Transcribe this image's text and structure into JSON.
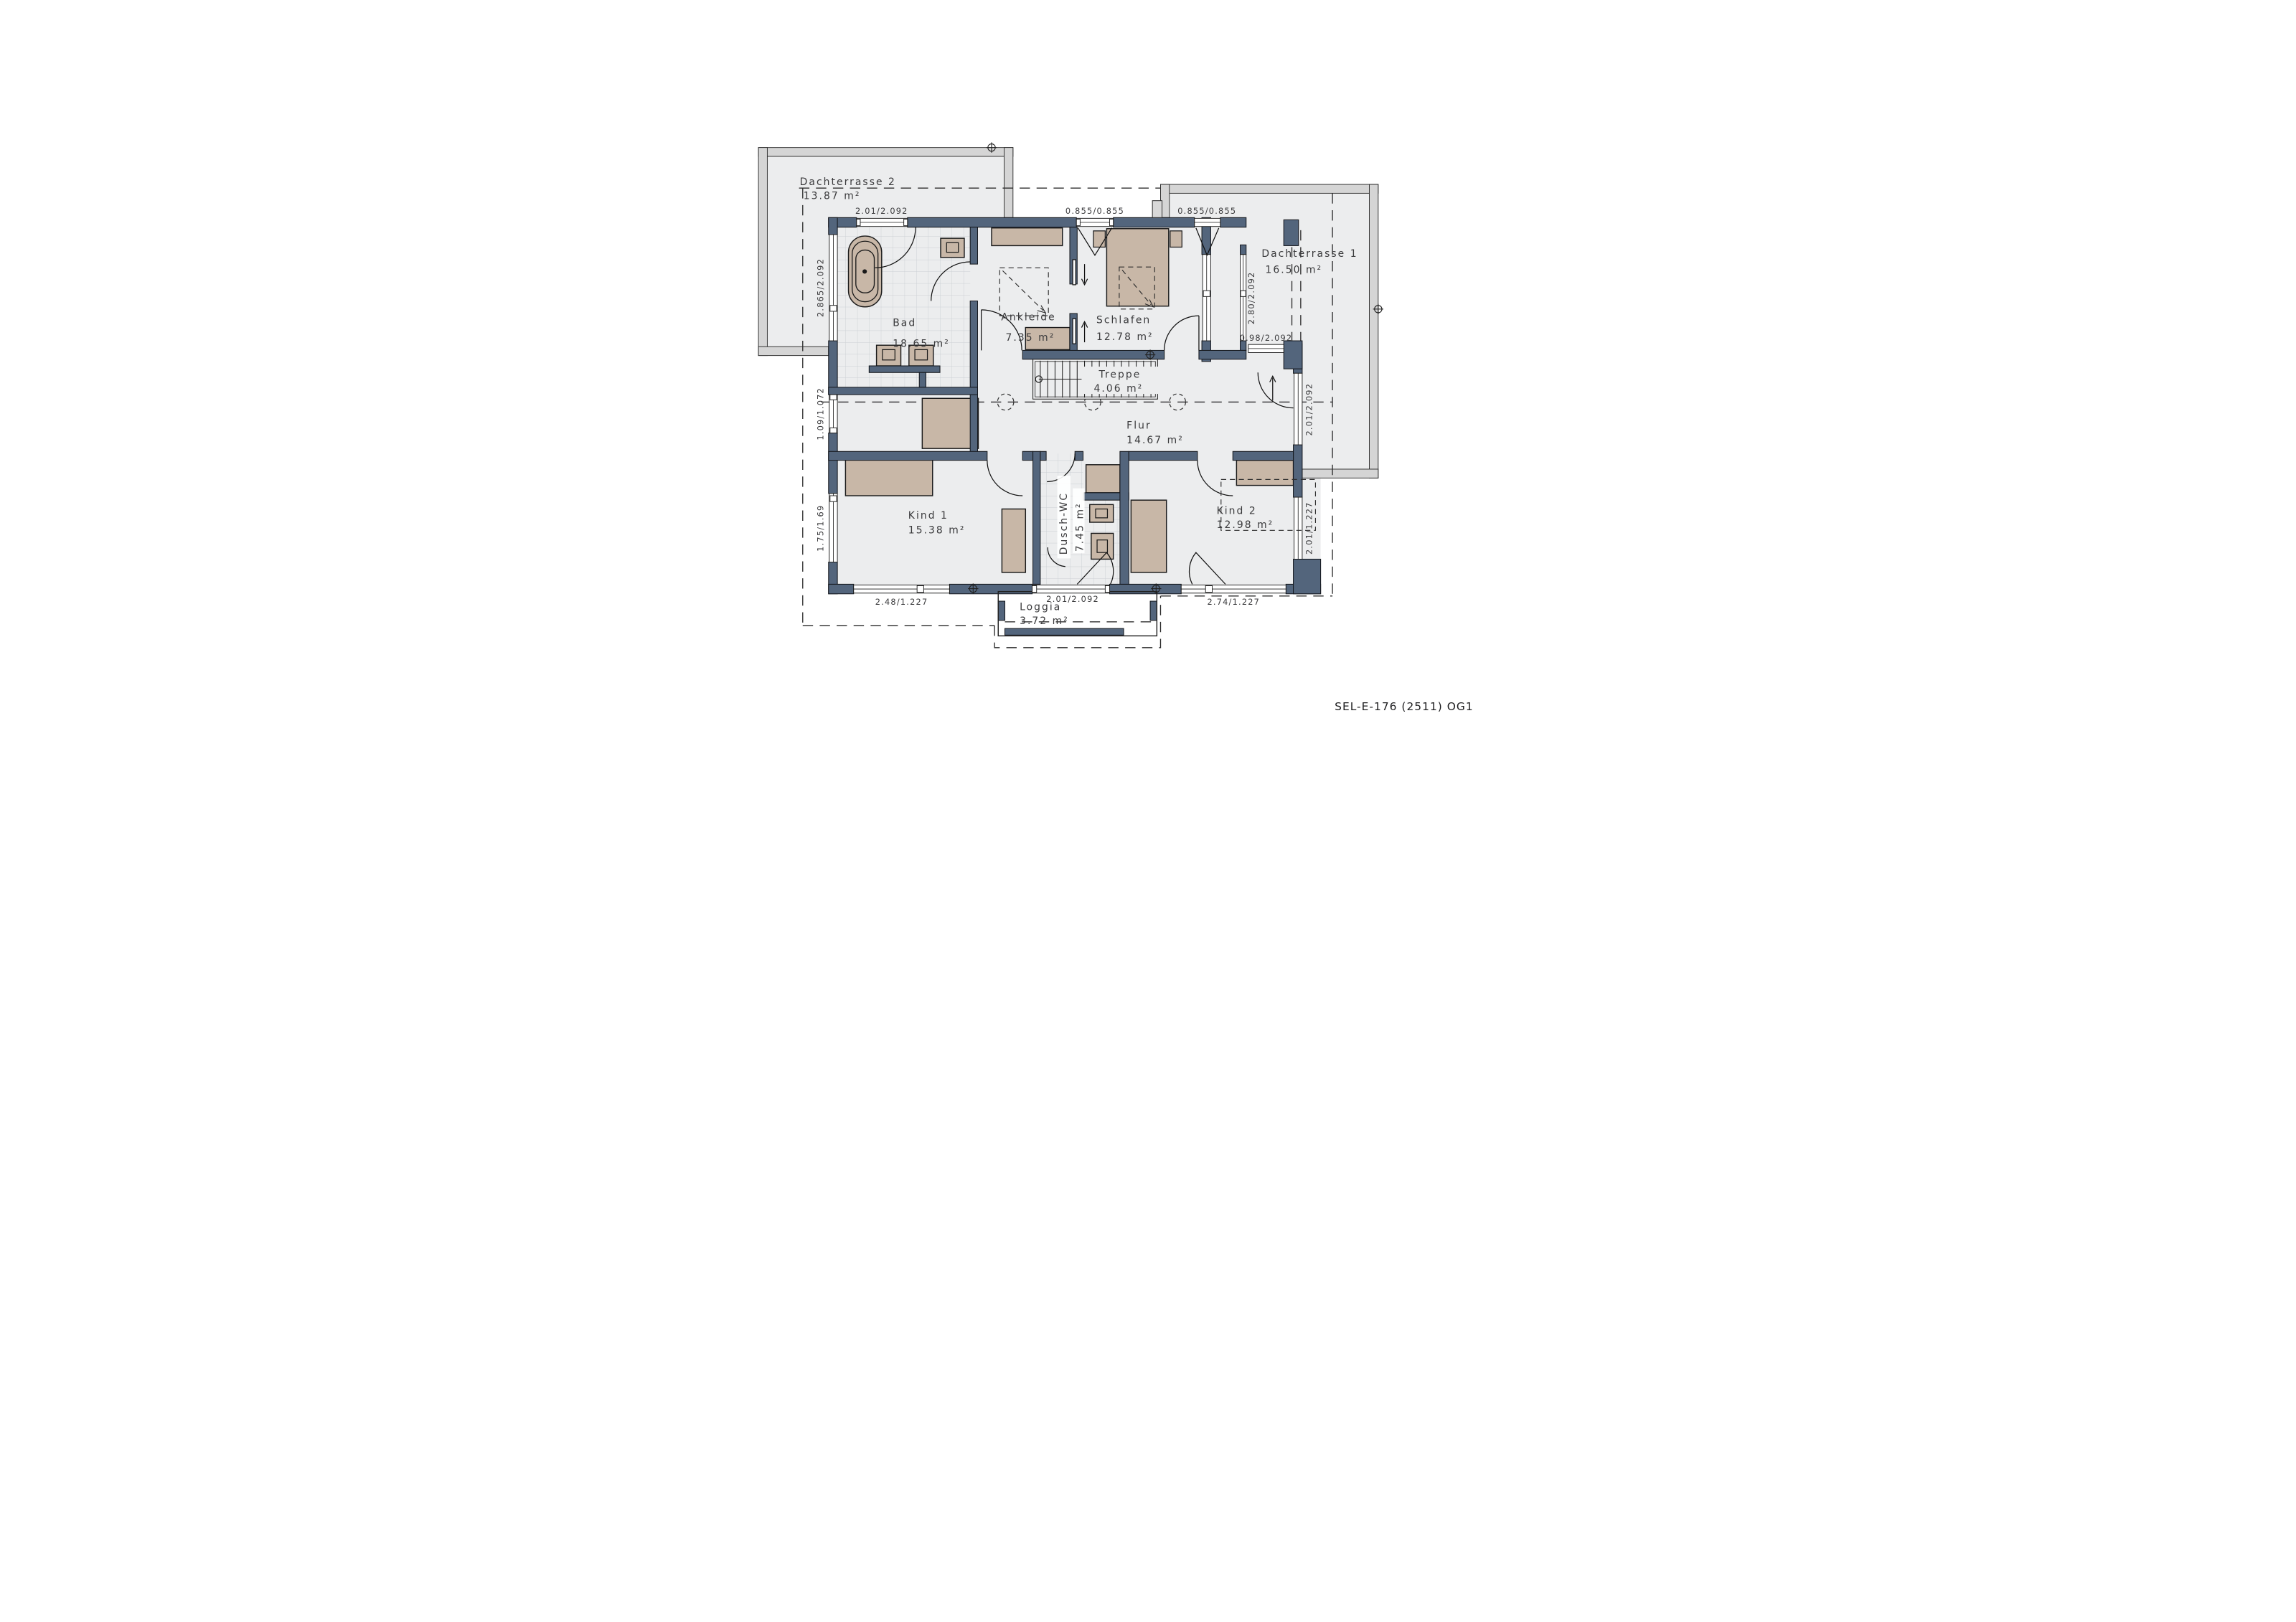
{
  "title": "SEL-E-176 (2511) OG1",
  "colors": {
    "wall": "#53657c",
    "floor": "#ecedee",
    "terrace_band": "#d5d5d5",
    "furniture": "#c8b7a7",
    "background": "#ffffff"
  },
  "rooms": {
    "dachterrasse2": {
      "name": "Dachterrasse 2",
      "area": "13.87 m²"
    },
    "dachterrasse1": {
      "name": "Dachterrasse 1",
      "area": "16.50 m²"
    },
    "bad": {
      "name": "Bad",
      "area": "18.65 m²"
    },
    "ankleide": {
      "name": "Ankleide",
      "area": "7.35 m²"
    },
    "schlafen": {
      "name": "Schlafen",
      "area": "12.78 m²"
    },
    "treppe": {
      "name": "Treppe",
      "area": "4.06 m²"
    },
    "flur": {
      "name": "Flur",
      "area": "14.67 m²"
    },
    "kind1": {
      "name": "Kind 1",
      "area": "15.38 m²"
    },
    "duschwc": {
      "name": "Dusch-WC",
      "area": "7.45 m²"
    },
    "kind2": {
      "name": "Kind 2",
      "area": "12.98 m²"
    },
    "loggia": {
      "name": "Loggia",
      "area": "3.72 m²"
    }
  },
  "dimensions": {
    "top_bad": "2.01/2.092",
    "top_ankleide": "0.855/0.855",
    "top_schlafen": "0.855/0.855",
    "left_bad": "2.865/2.092",
    "left_storage": "1.09/1.072",
    "left_kind1": "1.75/1.69",
    "right_schlafen": "2.80/2.092",
    "right_terrace_door": "0.98/2.092",
    "right_flur": "2.01/2.092",
    "right_kind2": "2.01/1.227",
    "bottom_kind1": "2.48/1.227",
    "bottom_loggia": "2.01/2.092",
    "bottom_kind2": "2.74/1.227"
  }
}
